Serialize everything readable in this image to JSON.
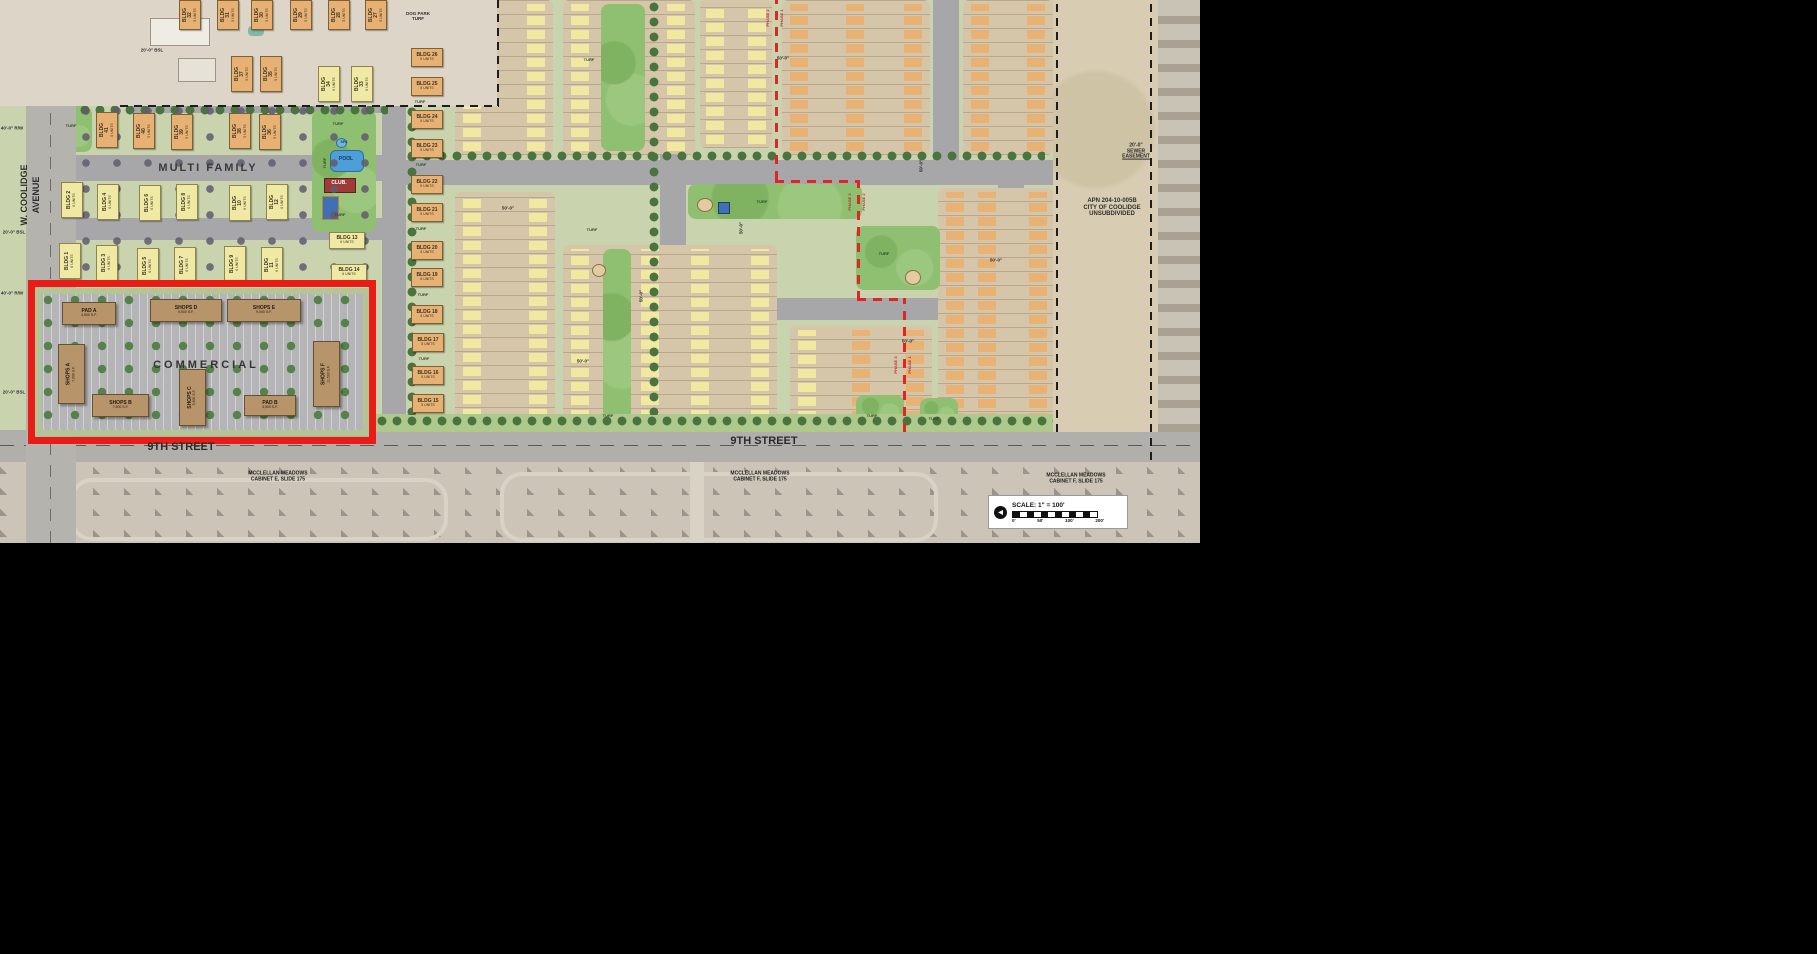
{
  "streets": {
    "w_coolidge_1": "W. COOLIDGE",
    "w_coolidge_2": "AVENUE",
    "ninth_street_w": "9TH STREET",
    "ninth_street_e": "9TH STREET"
  },
  "areas": {
    "multi_family": "MULTI FAMILY",
    "commercial": "COMMERCIAL",
    "dog_park_1": "DOG PARK",
    "dog_park_2": "TURF",
    "turf": "TURF"
  },
  "amen": {
    "pool": "POOL",
    "spa": "SPA",
    "club": "CLUB."
  },
  "phases": {
    "p1": "PHASE 1",
    "p2": "PHASE 2",
    "p3": "PHASE 3"
  },
  "dims": {
    "bsl20": "20'-0\" BSL",
    "rw40": "40'-0\" R/W",
    "d50": "50'-0\"",
    "sewer_1": "20'-0\"",
    "sewer_2": "SEWER",
    "sewer_3": "EASEMENT"
  },
  "parcel": {
    "apn": "APN 204-10-005B",
    "city": "CITY OF COOLIDGE",
    "status": "UNSUBDIVIDED"
  },
  "adjacent": {
    "mm_w_1": "MCCLELLAN MEADOWS",
    "mm_w_2": "CABINET E, SLIDE 175",
    "mm_c_1": "MCCLELLAN MEADOWS",
    "mm_c_2": "CABINET F, SLIDE 175",
    "mm_e_1": "MCCLELLAN MEADOWS",
    "mm_e_2": "CABINET F, SLIDE 175"
  },
  "scale": {
    "label": "SCALE: 1\" = 100'",
    "t0": "0'",
    "t50": "50'",
    "t100": "100'",
    "t200": "200'"
  },
  "icons": {
    "north_arrow": "◀"
  },
  "comm": {
    "pad_a": {
      "name": "PAD A",
      "sf": "4,500 S.F."
    },
    "shops_d": {
      "name": "SHOPS D",
      "sf": "9,500 S.F."
    },
    "shops_e": {
      "name": "SHOPS E",
      "sf": "9,000 S.F."
    },
    "shops_a": {
      "name": "SHOPS A",
      "sf": "7,000 S.F."
    },
    "shops_b": {
      "name": "SHOPS B",
      "sf": "7,500 S.F."
    },
    "shops_c": {
      "name": "SHOPS C",
      "sf": "5,500 S.F."
    },
    "pad_b": {
      "name": "PAD B",
      "sf": "4,500 S.F."
    },
    "shops_f": {
      "name": "SHOPS F",
      "sf": "11,500 S.F."
    }
  },
  "bldgs": {
    "b1": {
      "name": "BLDG 1",
      "units": "6 UNITS"
    },
    "b2": {
      "name": "BLDG 2",
      "units": "6 UNITS"
    },
    "b3": {
      "name": "BLDG 3",
      "units": "6 UNITS"
    },
    "b4": {
      "name": "BLDG 4",
      "units": "6 UNITS"
    },
    "b5": {
      "name": "BLDG 5",
      "units": "6 UNITS"
    },
    "b6": {
      "name": "BLDG 6",
      "units": "6 UNITS"
    },
    "b7": {
      "name": "BLDG 7",
      "units": "6 UNITS"
    },
    "b8": {
      "name": "BLDG 8",
      "units": "6 UNITS"
    },
    "b9": {
      "name": "BLDG 9",
      "units": "6 UNITS"
    },
    "b10": {
      "name": "BLDG 10",
      "units": "6 UNITS"
    },
    "b11": {
      "name": "BLDG 11",
      "units": "6 UNITS"
    },
    "b12": {
      "name": "BLDG 12",
      "units": "6 UNITS"
    },
    "b13": {
      "name": "BLDG 13",
      "units": "6 UNITS"
    },
    "b14": {
      "name": "BLDG 14",
      "units": "6 UNITS"
    },
    "b15": {
      "name": "BLDG 15",
      "units": "5 UNITS"
    },
    "b16": {
      "name": "BLDG 16",
      "units": "5 UNITS"
    },
    "b17": {
      "name": "BLDG 17",
      "units": "5 UNITS"
    },
    "b18": {
      "name": "BLDG 18",
      "units": "5 UNITS"
    },
    "b19": {
      "name": "BLDG 19",
      "units": "5 UNITS"
    },
    "b20": {
      "name": "BLDG 20",
      "units": "5 UNITS"
    },
    "b21": {
      "name": "BLDG 21",
      "units": "5 UNITS"
    },
    "b22": {
      "name": "BLDG 22",
      "units": "5 UNITS"
    },
    "b23": {
      "name": "BLDG 23",
      "units": "5 UNITS"
    },
    "b24": {
      "name": "BLDG 24",
      "units": "5 UNITS"
    },
    "b25": {
      "name": "BLDG 25",
      "units": "5 UNITS"
    },
    "b26": {
      "name": "BLDG 26",
      "units": "5 UNITS"
    },
    "b27": {
      "name": "BLDG 27",
      "units": "5 UNITS"
    },
    "b28": {
      "name": "BLDG 28",
      "units": "5 UNITS"
    },
    "b29": {
      "name": "BLDG 29",
      "units": "5 UNITS"
    },
    "b30": {
      "name": "BLDG 30",
      "units": "5 UNITS"
    },
    "b31": {
      "name": "BLDG 31",
      "units": "5 UNITS"
    },
    "b32": {
      "name": "BLDG 32",
      "units": "5 UNITS"
    },
    "b33": {
      "name": "BLDG 33",
      "units": "6 UNITS"
    },
    "b34": {
      "name": "BLDG 34",
      "units": "6 UNITS"
    },
    "b35": {
      "name": "BLDG 35",
      "units": "5 UNITS"
    },
    "b36": {
      "name": "BLDG 36",
      "units": "5 UNITS"
    },
    "b37": {
      "name": "BLDG 37",
      "units": "5 UNITS"
    },
    "b38": {
      "name": "BLDG 38",
      "units": "5 UNITS"
    },
    "b39": {
      "name": "BLDG 39",
      "units": "5 UNITS"
    },
    "b40": {
      "name": "BLDG 40",
      "units": "5 UNITS"
    },
    "b41": {
      "name": "BLDG 41",
      "units": "5 UNITS"
    }
  }
}
